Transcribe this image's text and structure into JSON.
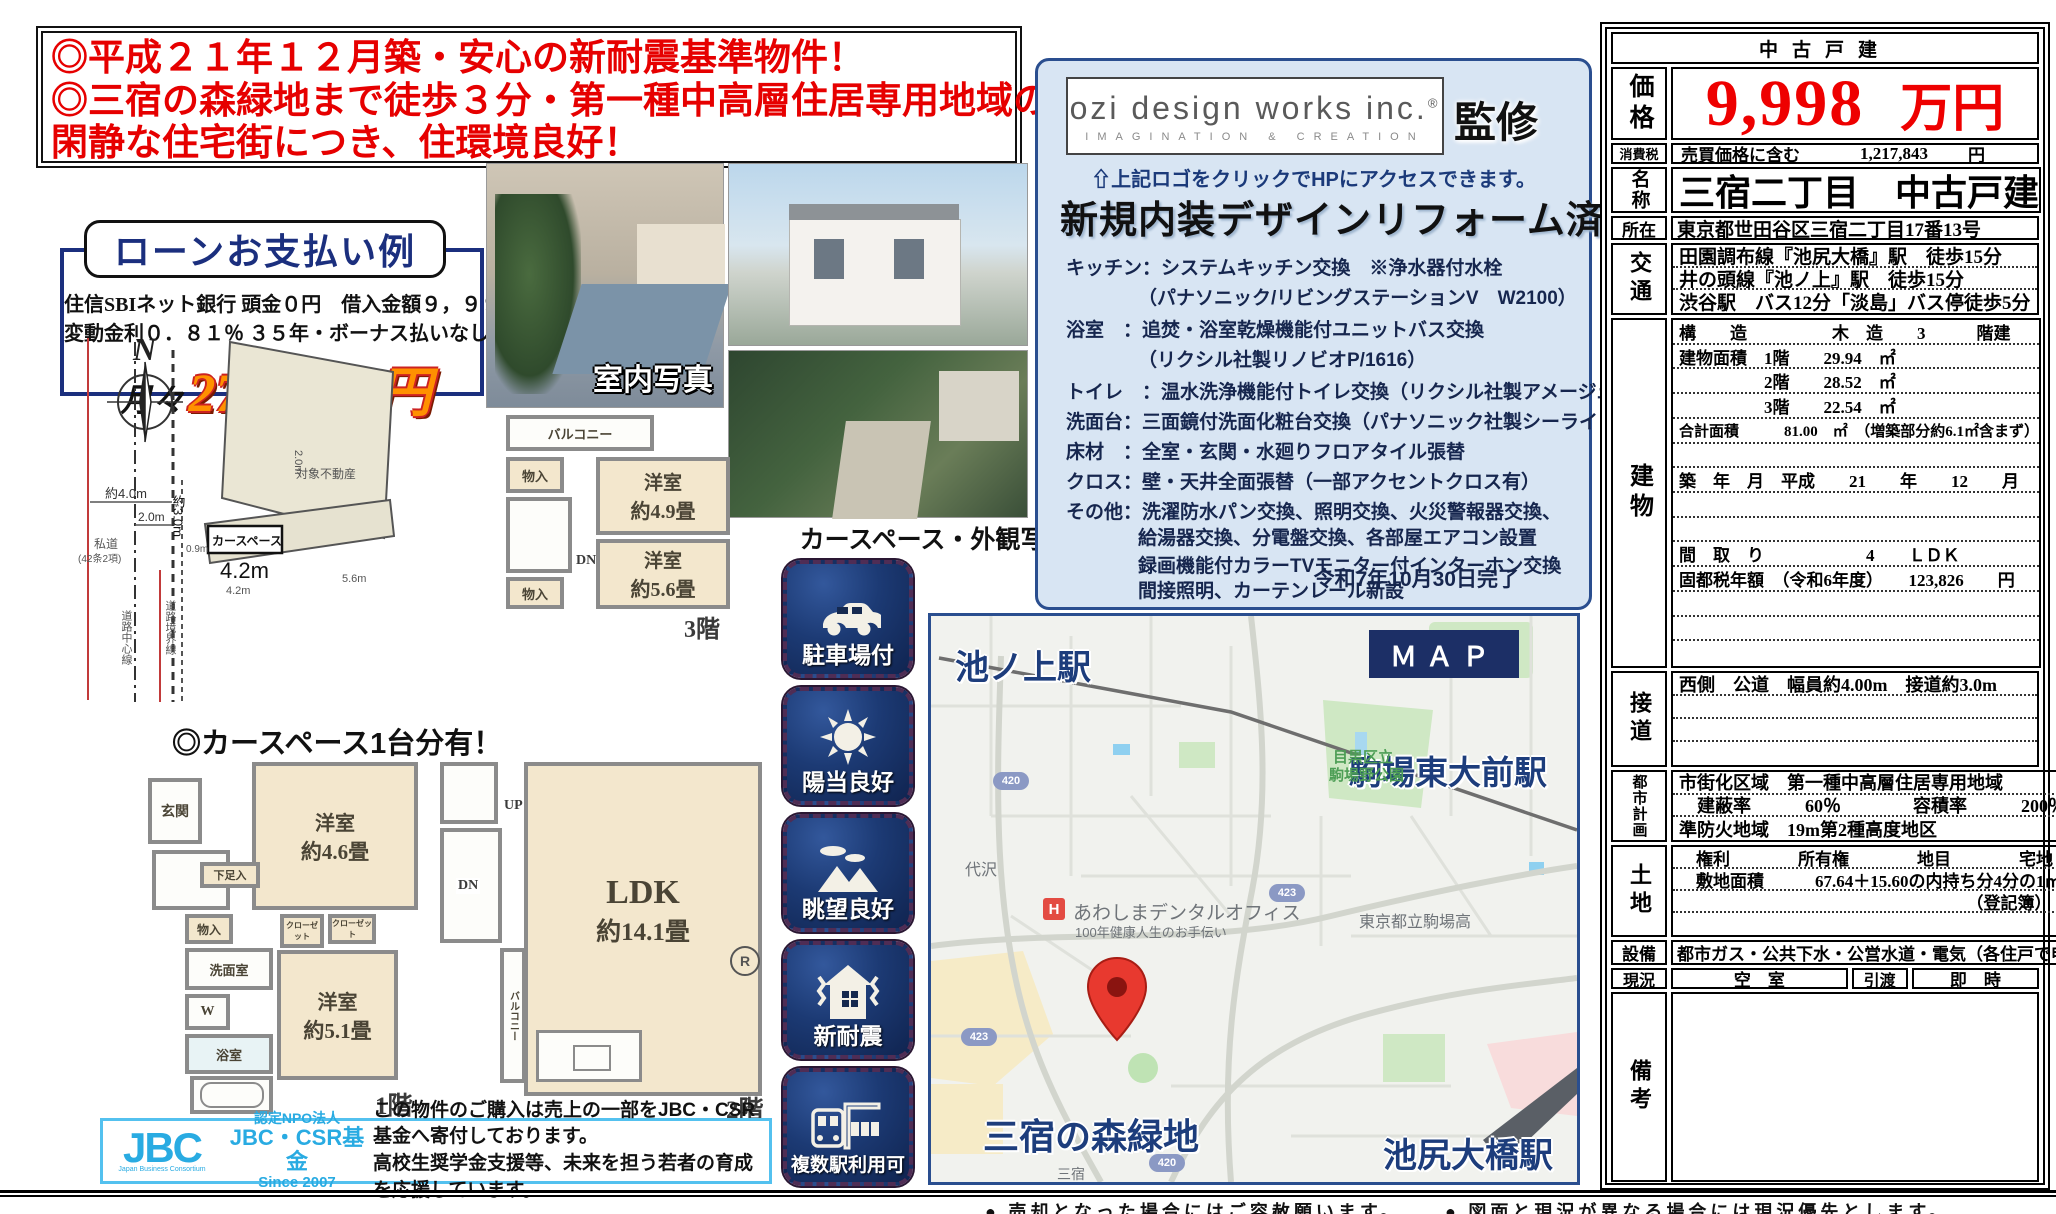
{
  "headline": {
    "line1": "◎平成２１年１２月築・安心の新耐震基準物件！",
    "line2": "◎三宿の森緑地まで徒歩３分・第一種中高層住居専用地域の",
    "line3": "閑静な住宅街につき、住環境良好！"
  },
  "loan": {
    "title": "ローンお支払い例",
    "line1": "住信SBIネット銀行 頭金０円　借入金額９，９９８万円",
    "line2": "変動金利０．８１％ ３５年・ボーナス払いなし",
    "monthly_prefix": "月々",
    "monthly_amount": "273, 462円"
  },
  "photos": {
    "interior_label": "室内写真",
    "exterior_label": "カースペース・外観写真"
  },
  "site": {
    "compass": "N",
    "note": "◎カースペース1台分有！",
    "parcel": "対象不動産",
    "carspace": "カースペース",
    "dim_40": "約4.0m",
    "dim_20": "2.0m",
    "dim_30": "約3.0m",
    "dim_09": "0.9m",
    "dim_42": "4.2m",
    "dim_42b": "4.2m",
    "dim_56": "5.6m",
    "dim_20b": "2.0m",
    "private_road1": "私道",
    "private_road2": "(42条2項)",
    "road_center": "道路中心線",
    "road_edge": "道路境界線"
  },
  "fp3": {
    "balcony": "バルコニー",
    "closet1": "物入",
    "closet2": "物入",
    "dn": "DN",
    "room1_name": "洋室",
    "room1_size": "約4.9畳",
    "room2_name": "洋室",
    "room2_size": "約5.6畳",
    "label": "3階"
  },
  "fp1": {
    "entrance": "玄関",
    "shoe": "下足入",
    "up": "UP",
    "room1_name": "洋室",
    "room1_size": "約4.6畳",
    "closet": "物入",
    "wash": "洗面室",
    "washer": "W",
    "bath": "浴室",
    "closet2": "クローゼット",
    "closet3": "クローゼット",
    "room2_name": "洋室",
    "room2_size": "約5.1畳",
    "label": "1階"
  },
  "fp2": {
    "up": "UP",
    "dn": "DN",
    "ldk_name": "LDK",
    "ldk_size": "約14.1畳",
    "balcony": "バルコニー",
    "r": "R",
    "label": "2階"
  },
  "supervisor": {
    "logo_line1": "ozi design works inc.",
    "logo_reg": "®",
    "logo_line2": "IMAGINATION  &  CREATION",
    "kanshu": "監修",
    "click_note": "⇧上記ロゴをクリックでHPにアクセスできます。",
    "reform_title": "新規内装デザインリフォーム済",
    "items": [
      "キッチン：システムキッチン交換　※浄水器付水栓",
      "（パナソニック/リビングステーションV　W2100）",
      "浴室　：追焚・浴室乾燥機能付ユニットバス交換",
      "（リクシル社製リノビオP/1616）",
      "トイレ　：温水洗浄機能付トイレ交換（リクシル社製アメージュZ+WS）",
      "洗面台：三面鏡付洗面化粧台交換（パナソニック社製シーラインW７５０）",
      "床材　：全室・玄関・水廻りフロアタイル張替",
      "クロス：壁・天井全面張替（一部アクセントクロス有）",
      "その他：洗濯防水パン交換、照明交換、火災警報器交換、",
      "給湯器交換、分電盤交換、各部屋エアコン設置",
      "録画機能付カラーTVモニター付インターホン交換",
      "間接照明、カーテンレール新設"
    ],
    "completion": "令和7年10月30日完了"
  },
  "badges": [
    {
      "label": "駐車場付"
    },
    {
      "label": "陽当良好"
    },
    {
      "label": "眺望良好"
    },
    {
      "label": "新耐震"
    },
    {
      "label": "複数駅利用可"
    }
  ],
  "map": {
    "button": "ＭＡＰ",
    "station1": "池ノ上駅",
    "station2": "駒場東大前駅",
    "station3": "池尻大橋駅",
    "green_area": "三宿の森緑地",
    "park1": "駒場",
    "park2_line1": "目黒区立",
    "park2_line2": "駒場野公園",
    "poi_h": "H",
    "poi_name": "あわしまデンタルオフィス",
    "poi_sub": "100年健康人生のお手伝い",
    "school": "東京都立駒場高",
    "area1": "代沢",
    "area2": "三宿",
    "route_420a": "420",
    "route_423a": "423",
    "route_423b": "423",
    "route_420b": "420"
  },
  "jbc": {
    "logo": "JBC",
    "logo_sub": "Japan Business Consortium",
    "npo": "認定NPO法人",
    "fund": "JBC・CSR基金",
    "since": "Since 2007",
    "line1": "この物件のご購入は売上の一部をJBC・CSR基金へ寄付しております。",
    "line2": "高校生奨学金支援等、未来を担う若者の育成を応援しています。"
  },
  "panel": {
    "header": "中古戸建",
    "price_label": "価格",
    "price_value": "9,998",
    "price_unit": "万円",
    "tax_label": "消費税",
    "tax_text": "売買価格に含む",
    "tax_value": "1,217,843",
    "tax_unit": "円",
    "name_label": "名称",
    "name_value": "三宿二丁目　中古戸建",
    "addr_label": "所在",
    "addr_value": "東京都世田谷区三宿二丁目17番13号",
    "access_label": "交通",
    "access_lines": [
      "田園調布線『池尻大橋』駅　徒歩15分",
      "井の頭線『池ノ上』駅　徒歩15分",
      "渋谷駅　バス12分「淡島」バス停徒歩5分"
    ],
    "building_label": "建物",
    "building_rows": [
      "構　　造　　　　　木　造　　3　　　階建",
      "建物面積　1階　　29.94　㎡",
      "　　　　　2階　　28.52　㎡",
      "　　　　　3階　　22.54　㎡",
      "合計面積　　　81.00　㎡　（増築部分約6.1㎡含まず）",
      "",
      "築　年　月　平成　　21　　年　　12　　月",
      "",
      "",
      "間　取　り　　　　　　4　　ＬＤＫ",
      "固都税年額　（令和6年度）　　123,826　　円",
      "",
      "",
      ""
    ],
    "road_label": "接道",
    "road_lines": [
      "西側　公道　幅員約4.00m　接道約3.0m",
      "",
      "",
      ""
    ],
    "city_label": "都市計画",
    "city_lines": [
      "市街化区域　第一種中高層住居専用地域",
      "　建蔽率　　　60％　　　　容積率　　　200％",
      "準防火地域　19m第2種高度地区"
    ],
    "land_label": "土地",
    "land_lines": [
      "　権利　　　　所有権　　　　地目　　　　宅地",
      "　敷地面積　　　67.64＋15.60の内持ち分4分の1㎡",
      "（登記簿）",
      ""
    ],
    "equip_label": "設備",
    "equip_value": "都市ガス・公共下水・公営水道・電気（各住戸で申込）",
    "status_label": "現況",
    "status_value": "空　室",
    "handover_label": "引渡",
    "handover_value": "即　時",
    "remarks_label": "備考"
  },
  "footer": {
    "note1": "● 売却となった場合にはご容赦願います。",
    "note2": "● 図面と現況が異なる場合には現況優先とします。"
  }
}
